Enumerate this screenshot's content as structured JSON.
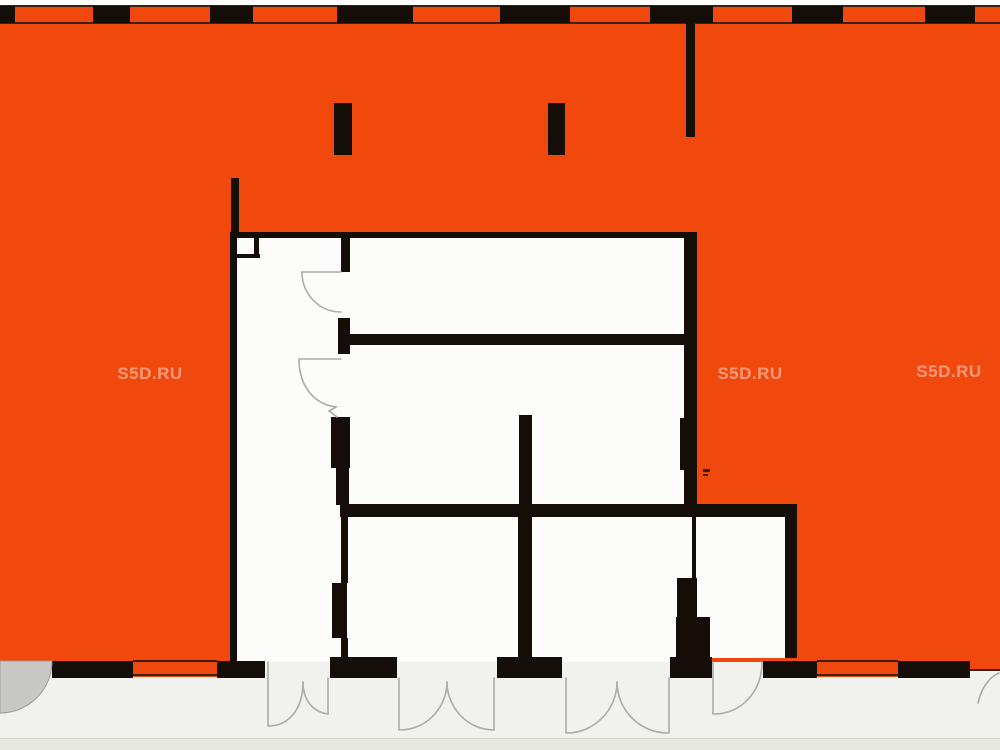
{
  "watermarks": [
    {
      "text": "S5D.RU",
      "x": 150,
      "y": 374
    },
    {
      "text": "S5D.RU",
      "x": 750,
      "y": 374
    },
    {
      "text": "S5D.RU",
      "x": 949,
      "y": 372
    }
  ],
  "colors": {
    "white": "#FFFFFF",
    "orange": "#F1480E",
    "wall": "#140D08",
    "line": "#3B2013",
    "room": "#FCFCFB",
    "outside": "#F1F1EE",
    "bottomBand": "#E8E8E3",
    "bandLine": "#D6D6D1",
    "arc": "#ABABA9",
    "grayDoorFill": "#C8C8C6",
    "grayDoorStroke": "#9C9C9A",
    "watermark": "rgba(255,255,255,0.45)"
  },
  "plan": {
    "canvas": {
      "w": 1000,
      "h": 750
    },
    "rects": [
      {
        "x": 0,
        "y": 0,
        "w": 1000,
        "h": 750,
        "c": "white",
        "n": "page-background"
      },
      {
        "x": 0,
        "y": 662,
        "w": 1000,
        "h": 88,
        "c": "outside",
        "n": "exterior-ground"
      },
      {
        "x": 0,
        "y": 738,
        "w": 1000,
        "h": 12,
        "c": "bottomBand",
        "n": "bottom-edge-band"
      },
      {
        "x": 0,
        "y": 738,
        "w": 1000,
        "h": 1,
        "c": "bandLine",
        "n": "bottom-edge-line"
      },
      {
        "x": 0,
        "y": 5,
        "w": 1000,
        "h": 657,
        "c": "orange",
        "n": "highlight-region"
      },
      {
        "x": 233,
        "y": 232,
        "w": 457,
        "h": 430,
        "c": "room",
        "n": "apartment-area"
      },
      {
        "x": 690,
        "y": 505,
        "w": 107,
        "h": 153,
        "c": "room",
        "n": "room-bottom-right"
      },
      {
        "x": 970,
        "y": 662,
        "w": 30,
        "h": 7,
        "c": "orange",
        "n": "orange-right-edge"
      },
      {
        "x": 968,
        "y": 669,
        "w": 32,
        "h": 2,
        "c": "line",
        "n": "wall-line"
      },
      {
        "x": 133,
        "y": 661,
        "w": 84,
        "h": 16,
        "c": "orange",
        "n": "window-bottom-left"
      },
      {
        "x": 133,
        "y": 660,
        "w": 84,
        "h": 2,
        "c": "line",
        "n": "window-sill-line"
      },
      {
        "x": 133,
        "y": 674,
        "w": 84,
        "h": 2,
        "c": "line",
        "n": "window-sill-line"
      },
      {
        "x": 817,
        "y": 661,
        "w": 81,
        "h": 16,
        "c": "orange",
        "n": "window-bottom-right"
      },
      {
        "x": 817,
        "y": 660,
        "w": 81,
        "h": 2,
        "c": "line",
        "n": "window-sill-line"
      },
      {
        "x": 817,
        "y": 674,
        "w": 81,
        "h": 2,
        "c": "line",
        "n": "window-sill-line"
      },
      {
        "x": 0,
        "y": 5,
        "w": 1000,
        "h": 2,
        "c": "line",
        "n": "top-facade-line"
      },
      {
        "x": 0,
        "y": 22,
        "w": 1000,
        "h": 2,
        "c": "line",
        "n": "top-facade-line"
      },
      {
        "x": 0,
        "y": 6,
        "w": 15,
        "h": 17,
        "c": "wall",
        "n": "top-wall-pier"
      },
      {
        "x": 93,
        "y": 6,
        "w": 37,
        "h": 17,
        "c": "wall",
        "n": "top-wall-pier"
      },
      {
        "x": 210,
        "y": 6,
        "w": 43,
        "h": 17,
        "c": "wall",
        "n": "top-wall-pier"
      },
      {
        "x": 337,
        "y": 6,
        "w": 76,
        "h": 17,
        "c": "wall",
        "n": "top-wall-pier"
      },
      {
        "x": 500,
        "y": 6,
        "w": 70,
        "h": 17,
        "c": "wall",
        "n": "top-wall-pier"
      },
      {
        "x": 650,
        "y": 6,
        "w": 63,
        "h": 17,
        "c": "wall",
        "n": "top-wall-pier"
      },
      {
        "x": 792,
        "y": 6,
        "w": 51,
        "h": 17,
        "c": "wall",
        "n": "top-wall-pier"
      },
      {
        "x": 925,
        "y": 6,
        "w": 50,
        "h": 17,
        "c": "wall",
        "n": "top-wall-pier"
      },
      {
        "x": 686,
        "y": 22,
        "w": 9,
        "h": 115,
        "c": "wall",
        "n": "hanging-wall"
      },
      {
        "x": 334,
        "y": 103,
        "w": 18,
        "h": 52,
        "c": "wall",
        "n": "column"
      },
      {
        "x": 548,
        "y": 103,
        "w": 17,
        "h": 52,
        "c": "wall",
        "n": "column"
      },
      {
        "x": 231,
        "y": 178,
        "w": 8,
        "h": 56,
        "c": "wall",
        "n": "left-wall-extension"
      },
      {
        "x": 233,
        "y": 232,
        "w": 461,
        "h": 6,
        "c": "wall",
        "n": "apartment-top-wall"
      },
      {
        "x": 230,
        "y": 232,
        "w": 7,
        "h": 430,
        "c": "wall",
        "n": "apartment-left-wall"
      },
      {
        "x": 684,
        "y": 232,
        "w": 13,
        "h": 285,
        "c": "wall",
        "n": "apartment-right-wall"
      },
      {
        "x": 680,
        "y": 418,
        "w": 17,
        "h": 52,
        "c": "wall",
        "n": "right-wall-pier"
      },
      {
        "x": 233,
        "y": 254,
        "w": 27,
        "h": 4,
        "c": "wall",
        "n": "corner-shaft-wall"
      },
      {
        "x": 254,
        "y": 236,
        "w": 5,
        "h": 22,
        "c": "wall",
        "n": "corner-shaft-wall"
      },
      {
        "x": 341,
        "y": 238,
        "w": 9,
        "h": 34,
        "c": "wall",
        "n": "corridor-wall"
      },
      {
        "x": 338,
        "y": 318,
        "w": 12,
        "h": 36,
        "c": "wall",
        "n": "corridor-wall-pier"
      },
      {
        "x": 347,
        "y": 334,
        "w": 340,
        "h": 11,
        "c": "wall",
        "n": "interior-wall-horizontal-1"
      },
      {
        "x": 331,
        "y": 417,
        "w": 19,
        "h": 51,
        "c": "wall",
        "n": "corridor-wall-pier"
      },
      {
        "x": 336,
        "y": 467,
        "w": 13,
        "h": 38,
        "c": "wall",
        "n": "corridor-wall"
      },
      {
        "x": 340,
        "y": 504,
        "w": 457,
        "h": 13,
        "c": "wall",
        "n": "interior-wall-horizontal-2"
      },
      {
        "x": 519,
        "y": 415,
        "w": 13,
        "h": 90,
        "c": "wall",
        "n": "middle-wall-upper"
      },
      {
        "x": 518,
        "y": 517,
        "w": 14,
        "h": 141,
        "c": "wall",
        "n": "middle-wall-lower"
      },
      {
        "x": 341,
        "y": 517,
        "w": 7,
        "h": 66,
        "c": "wall",
        "n": "corridor-wall-lower"
      },
      {
        "x": 332,
        "y": 583,
        "w": 15,
        "h": 55,
        "c": "wall",
        "n": "corridor-wall-pier"
      },
      {
        "x": 341,
        "y": 638,
        "w": 7,
        "h": 20,
        "c": "wall",
        "n": "corridor-wall-lower"
      },
      {
        "x": 692,
        "y": 517,
        "w": 4,
        "h": 61,
        "c": "wall",
        "n": "room-divider-wall"
      },
      {
        "x": 677,
        "y": 578,
        "w": 20,
        "h": 62,
        "c": "wall",
        "n": "room-divider-pier"
      },
      {
        "x": 676,
        "y": 617,
        "w": 34,
        "h": 41,
        "c": "wall",
        "n": "room-divider-base"
      },
      {
        "x": 785,
        "y": 505,
        "w": 12,
        "h": 153,
        "c": "wall",
        "n": "room-right-wall"
      },
      {
        "x": 52,
        "y": 661,
        "w": 81,
        "h": 17,
        "c": "wall",
        "n": "bottom-wall-segment"
      },
      {
        "x": 217,
        "y": 661,
        "w": 48,
        "h": 17,
        "c": "wall",
        "n": "bottom-wall-segment"
      },
      {
        "x": 330,
        "y": 657,
        "w": 67,
        "h": 21,
        "c": "wall",
        "n": "bottom-wall-segment"
      },
      {
        "x": 497,
        "y": 657,
        "w": 65,
        "h": 21,
        "c": "wall",
        "n": "bottom-wall-segment"
      },
      {
        "x": 670,
        "y": 657,
        "w": 42,
        "h": 21,
        "c": "wall",
        "n": "bottom-wall-segment"
      },
      {
        "x": 763,
        "y": 661,
        "w": 54,
        "h": 17,
        "c": "wall",
        "n": "bottom-wall-segment"
      },
      {
        "x": 898,
        "y": 661,
        "w": 72,
        "h": 17,
        "c": "wall",
        "n": "bottom-wall-segment"
      },
      {
        "x": 703,
        "y": 469,
        "w": 7,
        "h": 3,
        "c": "line",
        "n": "small-plan-mark"
      },
      {
        "x": 703,
        "y": 474,
        "w": 5,
        "h": 2,
        "c": "line",
        "n": "small-plan-mark"
      }
    ],
    "paths": [
      {
        "d": "M302,272 L341,272",
        "s": "arc",
        "w": 1.6,
        "f": "none",
        "n": "door-leaf"
      },
      {
        "d": "M302,272 C302,294 319,312 341,312",
        "s": "arc",
        "w": 1.6,
        "f": "none",
        "n": "door-swing-arc"
      },
      {
        "d": "M299,359 L341,359",
        "s": "arc",
        "w": 1.6,
        "f": "none",
        "n": "door-leaf"
      },
      {
        "d": "M299,359 C299,385 313,404 336,407 L329,411 L337,417",
        "s": "arc",
        "w": 1.6,
        "f": "none",
        "n": "door-swing-arc"
      },
      {
        "d": "M268,662 L268,726",
        "s": "arc",
        "w": 1.6,
        "f": "none",
        "n": "door-leaf"
      },
      {
        "d": "M303,682 C303,708 290,726 268,726",
        "s": "arc",
        "w": 1.6,
        "f": "none",
        "n": "door-swing-arc"
      },
      {
        "d": "M303,682 C303,700 313,712 328,714",
        "s": "arc",
        "w": 1.6,
        "f": "none",
        "n": "door-swing-arc"
      },
      {
        "d": "M328,678 L328,714",
        "s": "arc",
        "w": 1.6,
        "f": "none",
        "n": "door-leaf"
      },
      {
        "d": "M399,678 L399,730",
        "s": "arc",
        "w": 1.6,
        "f": "none",
        "n": "door-leaf"
      },
      {
        "d": "M494,678 L494,730",
        "s": "arc",
        "w": 1.6,
        "f": "none",
        "n": "door-leaf"
      },
      {
        "d": "M447,682 C447,708 426,730 400,730",
        "s": "arc",
        "w": 1.6,
        "f": "none",
        "n": "door-swing-arc"
      },
      {
        "d": "M447,682 C447,708 468,730 494,730",
        "s": "arc",
        "w": 1.6,
        "f": "none",
        "n": "door-swing-arc"
      },
      {
        "d": "M566,678 L566,733",
        "s": "arc",
        "w": 1.6,
        "f": "none",
        "n": "door-leaf"
      },
      {
        "d": "M669,678 L669,733",
        "s": "arc",
        "w": 1.6,
        "f": "none",
        "n": "door-leaf"
      },
      {
        "d": "M617,682 C617,710 594,733 567,733",
        "s": "arc",
        "w": 1.6,
        "f": "none",
        "n": "door-swing-arc"
      },
      {
        "d": "M617,682 C617,710 640,733 668,733",
        "s": "arc",
        "w": 1.6,
        "f": "none",
        "n": "door-swing-arc"
      },
      {
        "d": "M713,662 L713,714",
        "s": "arc",
        "w": 1.6,
        "f": "none",
        "n": "door-leaf"
      },
      {
        "d": "M762,662 C762,692 741,714 714,714",
        "s": "arc",
        "w": 1.6,
        "f": "none",
        "n": "door-swing-arc"
      },
      {
        "d": "M999,673 C989,677 981,689 978,703",
        "s": "arc",
        "w": 1.6,
        "f": "none",
        "n": "door-swing-arc-partial"
      },
      {
        "d": "M0,661 L52,661 A52,52 0 0 1 0,713 Z",
        "s": "grayDoorStroke",
        "w": 1,
        "f": "grayDoorFill",
        "n": "door-swing-shaded"
      }
    ]
  }
}
